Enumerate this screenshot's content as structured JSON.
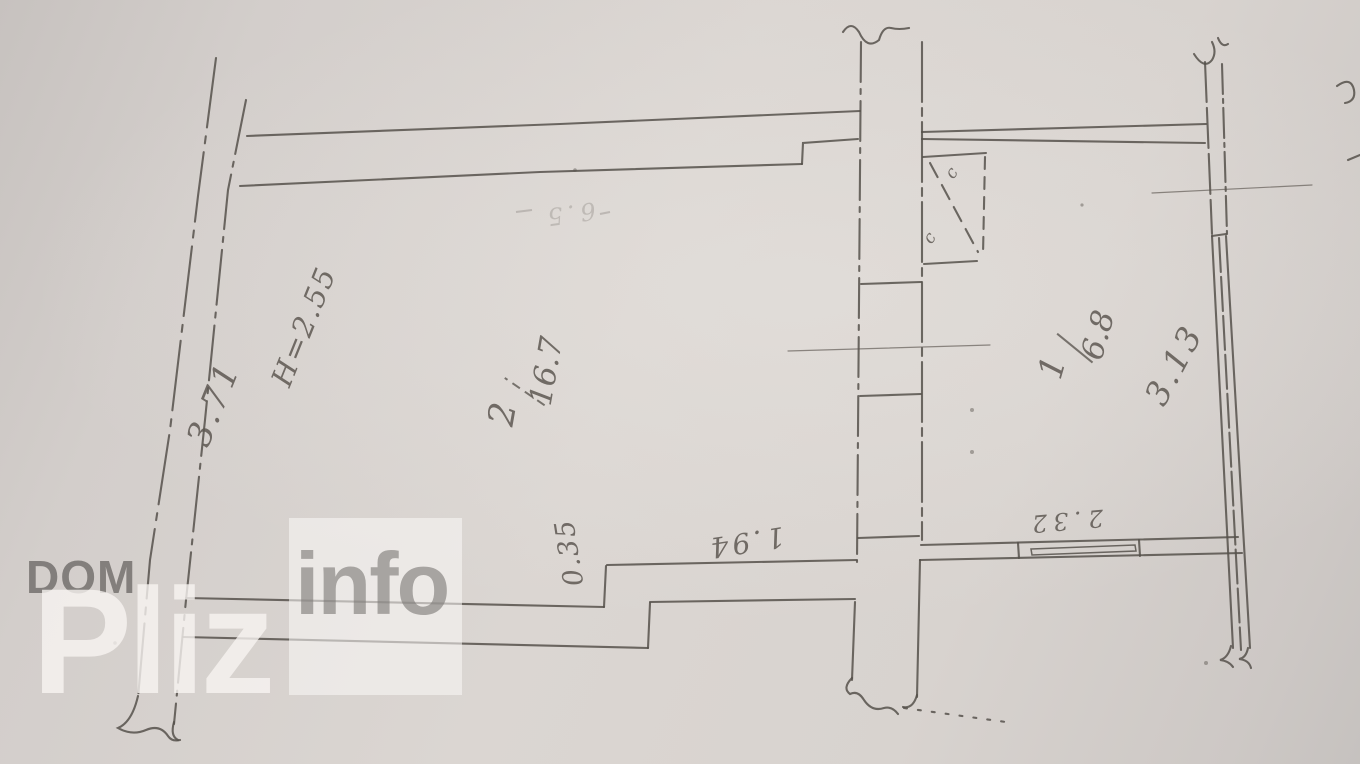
{
  "watermark": {
    "dom": "DOM",
    "pliz": "Pliz",
    "info": "info"
  },
  "rooms": {
    "room2": {
      "number": "2",
      "area": "16.7"
    },
    "room1": {
      "number": "1",
      "area": "6.8"
    }
  },
  "dimensions": {
    "left_wall_length": "3.71",
    "ceiling_height": "H=2.55",
    "right_wall_length": "3.13",
    "wall_offset": "0.35",
    "opening_width": "1.94",
    "window_width": "2.32",
    "faint_note": "6.5"
  },
  "marks": {
    "closet_mark_a": "c",
    "closet_mark_b": "c"
  }
}
